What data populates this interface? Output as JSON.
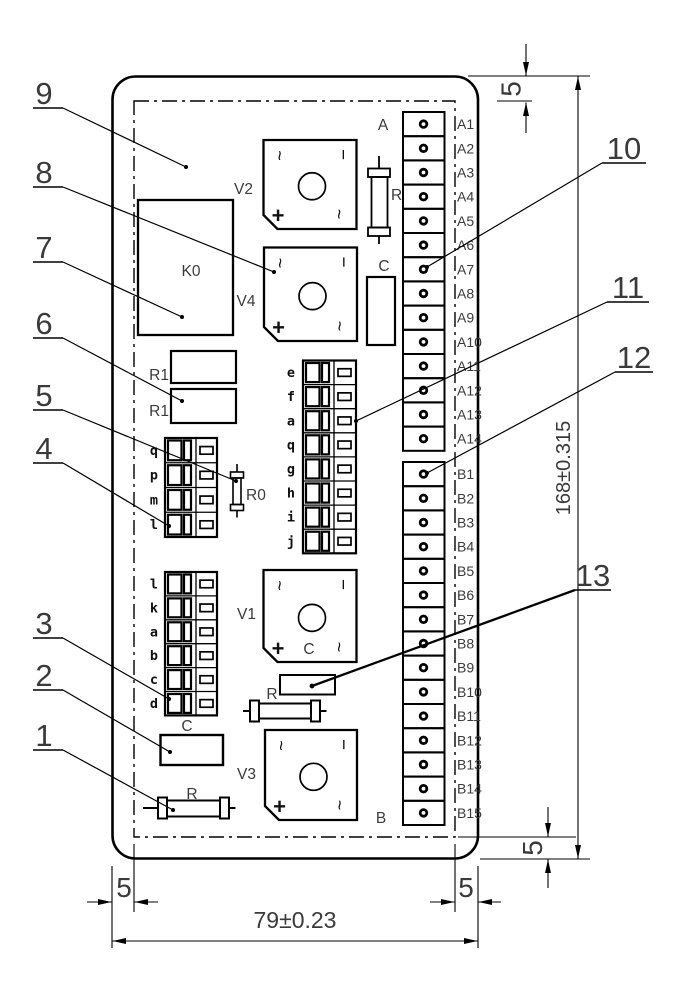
{
  "drawing_type": "PCB assembly engineering drawing",
  "callouts": {
    "left": [
      "9",
      "8",
      "7",
      "6",
      "5",
      "4",
      "3",
      "2",
      "1"
    ],
    "right": [
      "10",
      "11",
      "12",
      "13"
    ]
  },
  "dimensions": {
    "board_width": "79±0.23",
    "board_height": "168±0.315",
    "edge_margin": "5"
  },
  "terminal_strip_a": {
    "label": "A",
    "terminals": [
      "A1",
      "A2",
      "A3",
      "A4",
      "A5",
      "A6",
      "A7",
      "A8",
      "A9",
      "A10",
      "A11",
      "A12",
      "A13",
      "A14"
    ]
  },
  "terminal_strip_b": {
    "label": "B",
    "terminals": [
      "B1",
      "B2",
      "B3",
      "B4",
      "B5",
      "B6",
      "B7",
      "B8",
      "B9",
      "B10",
      "B11",
      "B12",
      "B13",
      "B14",
      "B15"
    ]
  },
  "letter_block_upper": {
    "letters": [
      "q",
      "p",
      "m",
      "l"
    ]
  },
  "letter_block_middle": {
    "letters": [
      "e",
      "f",
      "a",
      "q",
      "g",
      "h",
      "i",
      "j"
    ]
  },
  "letter_block_lower": {
    "letters": [
      "l",
      "k",
      "a",
      "b",
      "c",
      "d"
    ]
  },
  "components": {
    "relay": "K0",
    "bridge_v2": "V2",
    "bridge_v4": "V4",
    "bridge_v1": "V1",
    "bridge_v3": "V3",
    "bridge_marks": {
      "ac": "~",
      "minus": "−",
      "plus": "+"
    },
    "v1_center_mark": "C",
    "fuse_top": "R",
    "r0": "R0",
    "r1_upper": "R1",
    "r1_lower": "R1",
    "cap_top": "C",
    "cap_bottom": "C",
    "resistor_mid": "R",
    "resistor_bottom": "R"
  }
}
